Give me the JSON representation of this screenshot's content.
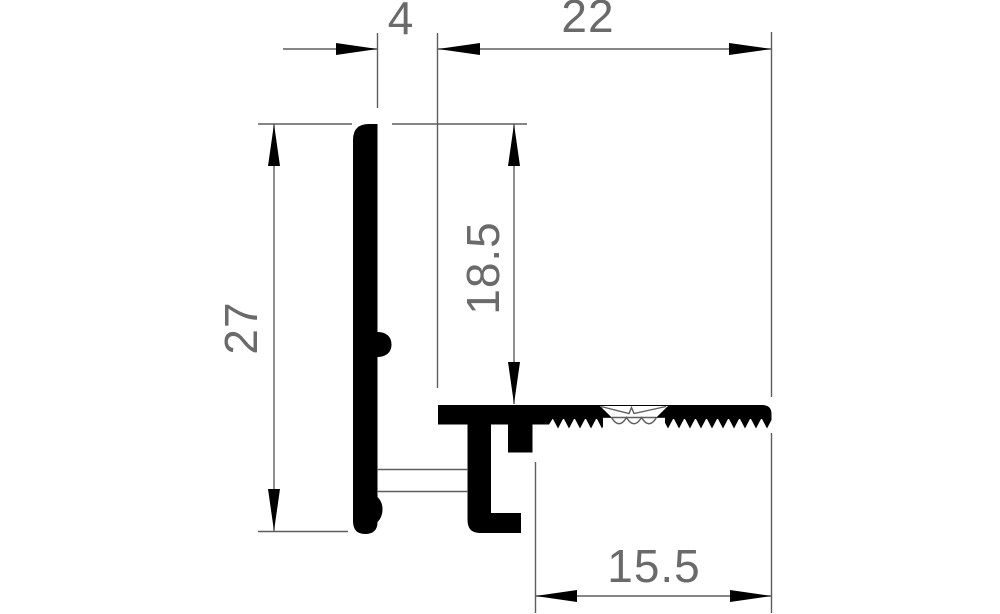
{
  "dimensions": {
    "lip_offset": {
      "value": "4"
    },
    "top_width": {
      "value": "22"
    },
    "overall_height": {
      "value": "27"
    },
    "inner_height": {
      "value": "18.5"
    },
    "bottom_width": {
      "value": "15.5"
    }
  },
  "colors": {
    "profile_fill": "#000000",
    "dimension_lines": "#5e5e5e",
    "dimension_text": "#6a6a6a",
    "background": "#ffffff"
  }
}
